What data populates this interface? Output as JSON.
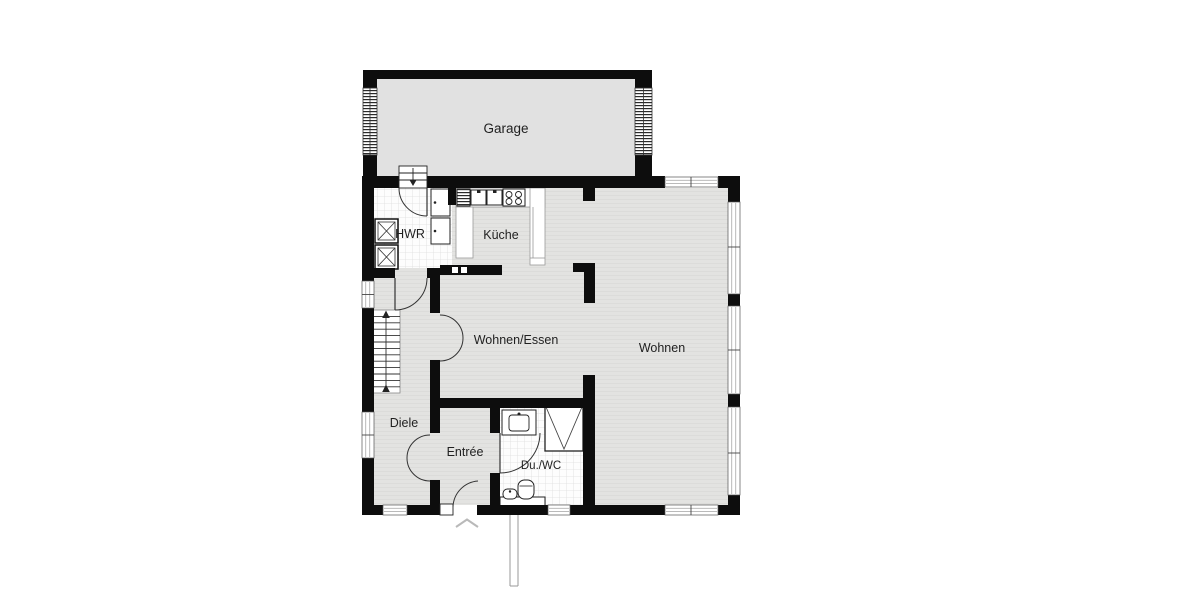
{
  "plan": {
    "type": "floor-plan",
    "level_hint": "ground floor with attached garage",
    "rooms": [
      {
        "id": "garage",
        "label": "Garage",
        "floor": "concrete"
      },
      {
        "id": "hwr",
        "label": "HWR",
        "floor": "tile"
      },
      {
        "id": "kueche",
        "label": "Küche",
        "floor": "wood"
      },
      {
        "id": "wohnen_essen",
        "label": "Wohnen/Essen",
        "floor": "wood"
      },
      {
        "id": "wohnen",
        "label": "Wohnen",
        "floor": "wood"
      },
      {
        "id": "diele",
        "label": "Diele",
        "floor": "wood"
      },
      {
        "id": "entree",
        "label": "Entrée",
        "floor": "wood"
      },
      {
        "id": "du_wc",
        "label": "Du./WC",
        "floor": "tile"
      }
    ],
    "colors": {
      "wall": "#0d0d0d",
      "floor_wood": "#e3e3e1",
      "floor_wood_stripe": "#dcdcda",
      "floor_garage": "#e1e1e1",
      "tile_floor": "#fdfdfd",
      "tile_line": "#dddddd",
      "window_glass": "#ffffff",
      "window_line": "#b0b0b0",
      "door_arc": "#333333",
      "label_text": "#1f1f1f",
      "path_line": "#999999",
      "chevron": "#b9b9b9"
    },
    "fixtures": [
      "garage-entry-steps",
      "washing-machine",
      "washing-machine",
      "storage-cabinet",
      "storage-cabinet",
      "kitchen-counter",
      "dishwasher",
      "double-sink",
      "cooktop",
      "staircase",
      "double-swing-door",
      "double-swing-door",
      "entry-door",
      "shower",
      "washbasin",
      "toilet",
      "hand-basin",
      "entry-path"
    ]
  }
}
